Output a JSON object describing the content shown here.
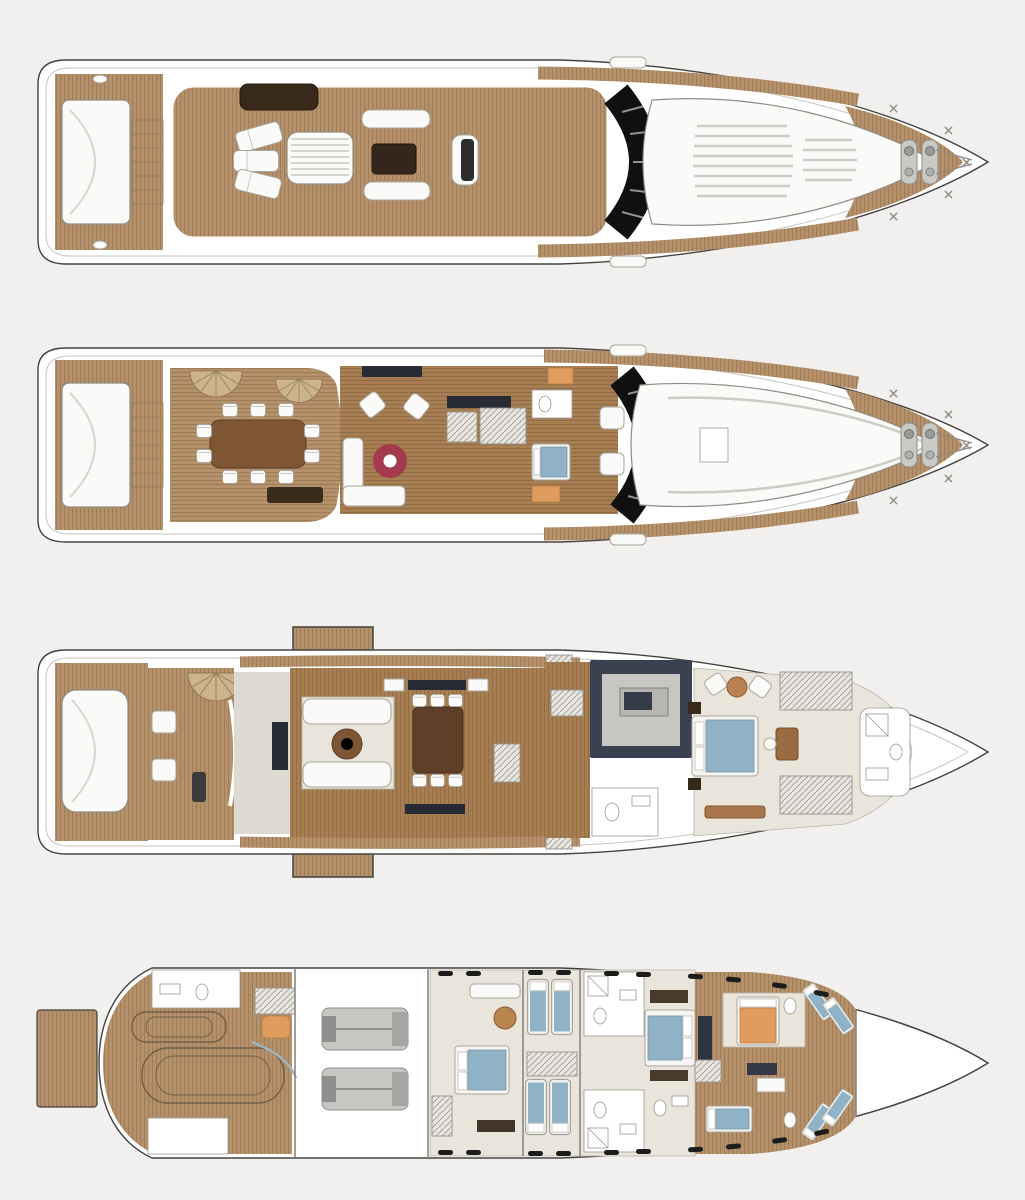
{
  "background": "#f1f0ee",
  "palette": {
    "bg": "#f1f0ee",
    "hull": "#ffffff",
    "hull_stroke": "#45433f",
    "teak": "#b4916a",
    "teak_line": "#97754f",
    "wood": "#a67e52",
    "wood_line": "#8a6540",
    "cream": "#e9e5da",
    "furn": "#fafaf8",
    "furn_stroke": "#a9a59c",
    "glass": "#101010",
    "bed_blue": "#8fb2c6",
    "rug_red": "#a43a4e",
    "orange": "#df9c5e",
    "engine": "#c6c6c3",
    "engine_dark": "#8f8f8c",
    "galley_dark": "#3a4150",
    "island_gray": "#b7b6b2",
    "table_wood": "#7e5634",
    "dark_wood": "#38291b",
    "tv_dark": "#262b35",
    "gray_floor": "#dcdad3",
    "hatch_bg": "#e7e5df"
  },
  "decks": [
    {
      "id": "sun-deck"
    },
    {
      "id": "bridge-deck"
    },
    {
      "id": "main-deck"
    },
    {
      "id": "lower-deck"
    }
  ]
}
